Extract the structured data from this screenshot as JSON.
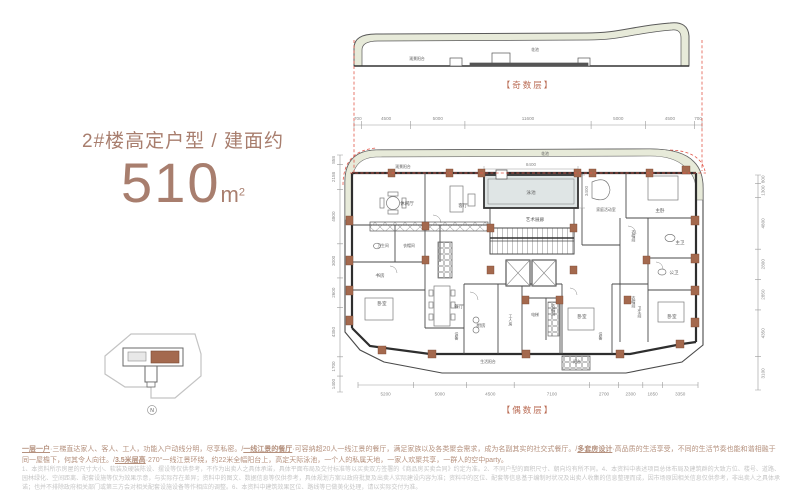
{
  "title": {
    "prefix": "2#楼高定户型 / 建面约",
    "area": "510",
    "unit": "m",
    "sup": "2"
  },
  "colors": {
    "accent": "#a87e6e",
    "caption": "#b96a52",
    "dashed": "#e2574a",
    "column": "#a4694e",
    "band": "#e7ead9",
    "pool_fill": "#dfe5e5",
    "dim_text": "#8a8a8a"
  },
  "odd_floor": {
    "caption": "【奇数层】",
    "flower_bed": "花池",
    "view_balcony": "观景阳台",
    "dims": [
      "700",
      "4500",
      "5000",
      "11600",
      "5000",
      "4500",
      "700"
    ]
  },
  "even_floor": {
    "caption": "【偶数层】",
    "dims_bottom": [
      "5200",
      "5000",
      "4500",
      "7100",
      "2700",
      "2300",
      "1850",
      "3350"
    ],
    "dims_left": [
      "858",
      "2158",
      "4800",
      "3000",
      "2600",
      "4350",
      "1700",
      "1400"
    ],
    "dims_right": [
      "800",
      "1300",
      "4800",
      "2800",
      "2850",
      "4350",
      "3100"
    ],
    "pool": {
      "label": "泳池",
      "width": "8400",
      "height": "3400"
    },
    "labels": {
      "flower_bed": "花池",
      "view_balcony": "观景阳台",
      "leisure_hall": "休闲厅",
      "living_room": "客厅",
      "art_gallery": "艺术展廊",
      "family_room": "家庭活动室",
      "master_bedroom": "主卧",
      "master_bath": "主卫",
      "guest_bath": "公卫",
      "cloakroom": "衣帽间",
      "bathroom": "卫生间",
      "study": "书房",
      "bedroom": "卧室",
      "dining_room": "餐厅",
      "kitchen": "厨房",
      "maid_room": "工人房",
      "elevator": "电梯",
      "equipment": "设备",
      "service_balcony": "生活阳台",
      "balcony": "阳台"
    }
  },
  "site_thumb": {
    "north": "N"
  },
  "footnotes": {
    "highlights": [
      {
        "head": "一层一户",
        "body": "·三梯直达家人、客人、工人，功能入户动线分明，尽享私密。/"
      },
      {
        "head": "一线江景的餐厅",
        "body": "·可容纳超20人一线江景的餐厅，满足家族以及各类聚会需求，成为名副其实的社交式餐厅。/"
      },
      {
        "head": "多套房设计",
        "body": "·高品质的生活享受，不同的生活节奏也能和谐相融于同一屋檐下，何其令人向往。/"
      },
      {
        "head": "3.5米层高",
        "body": "·270°一线江景环绕，约22米全幅阳台上，高定天际泳池，一个人的私属天地，一家人欢聚共享，一群人的空中party。"
      }
    ],
    "disclaimer": "1、本资料所示房屋的尺寸大小、软装及硬装陈设、摆设等仅供参考，不作为出卖人之具体承诺，具体平面布局及交付标准等以买卖双方签署的《商品房买卖合同》约定为准。2、不同户型的面积尺寸、朝向均有所不同。4、本资料中表述项目总体布局及建筑群的大致方位、楼号、道路、园林绿化、空间距离、配套设施等仅为效果示意，与实际存在差异；资料中的图文、数据信息等仅供参考，具体规划方案以政府批复及出卖人实际建设内容为准；资料中的区位、配套等信息基于编制时状况及出卖人收集的信息整理而成，因市场原因相关信息仅供参考，非出卖人之具体承诺；也并不排除政府相关部门或第三方会对相关配套设施设备等作相应的调整。6、本资料中建筑效果区位、路线等已做美化处理，请以实际交付为准。"
  }
}
